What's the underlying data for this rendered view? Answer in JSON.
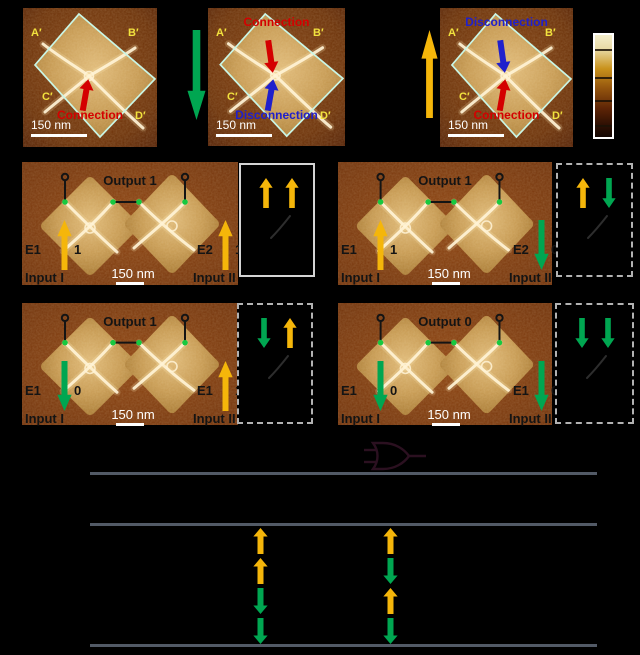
{
  "colors": {
    "background": "#000000",
    "up_arrow": "#f5b60a",
    "down_arrow": "#00a651",
    "red": "#d40000",
    "blue": "#2020cc",
    "corner_label": "#f2e23e",
    "diamond_outline": "#c9f6e6",
    "table_line": "#525a66",
    "scale_text": "#ffffff",
    "panel_text": "#141414",
    "green_dot": "#17c93f",
    "afm_brown": "#6b3007",
    "afm_tan": "#c79a52"
  },
  "panel_a": {
    "images": [
      {
        "corners": [
          "A′",
          "B′",
          "C′",
          "D′"
        ],
        "anno_top": null,
        "arrow_upper": null,
        "arrow_lower": {
          "dir": "up",
          "color": "#d40000"
        },
        "anno_bottom": {
          "text": "Connection",
          "color": "#d40000"
        },
        "scale_label": "150 nm"
      },
      {
        "corners": [
          "A′",
          "B′",
          "C′",
          "D′"
        ],
        "anno_top": {
          "text": "Connection",
          "color": "#d40000"
        },
        "arrow_upper": {
          "dir": "down",
          "color": "#d40000"
        },
        "arrow_lower": {
          "dir": "up",
          "color": "#2020cc"
        },
        "anno_bottom": {
          "text": "Disconnection",
          "color": "#2020cc"
        },
        "scale_label": "150 nm"
      },
      {
        "corners": [
          "A′",
          "B′",
          "C′",
          "D′"
        ],
        "anno_top": {
          "text": "Disconnection",
          "color": "#2020cc"
        },
        "arrow_upper": {
          "dir": "down",
          "color": "#2020cc"
        },
        "arrow_lower": {
          "dir": "up",
          "color": "#d40000"
        },
        "anno_bottom": {
          "text": "Connection",
          "color": "#d40000"
        },
        "scale_label": "150 nm"
      }
    ],
    "transition_arrows": [
      {
        "dir": "down",
        "color": "#00a651"
      },
      {
        "dir": "up",
        "color": "#f5b60a"
      }
    ]
  },
  "colorbar": {
    "gradient": [
      "#f4eecb",
      "#e8d9a4",
      "#c9921c",
      "#94550e",
      "#5d2406",
      "#140702"
    ],
    "tick_count": 4
  },
  "gate_panels": [
    {
      "output_label": "Output 1",
      "e_left": "E1",
      "bit_left": "1",
      "arrow_left": "up",
      "e_right": "E2",
      "bit_right": "1",
      "arrow_right": "up",
      "input_left": "Input I",
      "input_right": "Input II",
      "scale_label": "150 nm",
      "mfm_arrows": [
        "up",
        "up"
      ]
    },
    {
      "output_label": "Output 1",
      "e_left": "E1",
      "bit_left": "1",
      "arrow_left": "up",
      "e_right": "E2",
      "bit_right": "0",
      "arrow_right": "down",
      "input_left": "Input I",
      "input_right": "Input II",
      "scale_label": "150 nm",
      "mfm_arrows": [
        "up",
        "down"
      ]
    },
    {
      "output_label": "Output 1",
      "e_left": "E1",
      "bit_left": "0",
      "arrow_left": "down",
      "e_right": "E1",
      "bit_right": "1",
      "arrow_right": "up",
      "input_left": "Input I",
      "input_right": "Input II",
      "scale_label": "150 nm",
      "mfm_arrows": [
        "down",
        "up"
      ]
    },
    {
      "output_label": "Output 0",
      "e_left": "E1",
      "bit_left": "0",
      "arrow_left": "down",
      "e_right": "E1",
      "bit_right": "0",
      "arrow_right": "down",
      "input_left": "Input I",
      "input_right": "Input II",
      "scale_label": "150 nm",
      "mfm_arrows": [
        "down",
        "down"
      ]
    }
  ],
  "truth_table": {
    "gate_icon": "or-gate",
    "rows": [
      [
        "up",
        "up"
      ],
      [
        "up",
        "down"
      ],
      [
        "down",
        "up"
      ],
      [
        "down",
        "down"
      ]
    ]
  }
}
